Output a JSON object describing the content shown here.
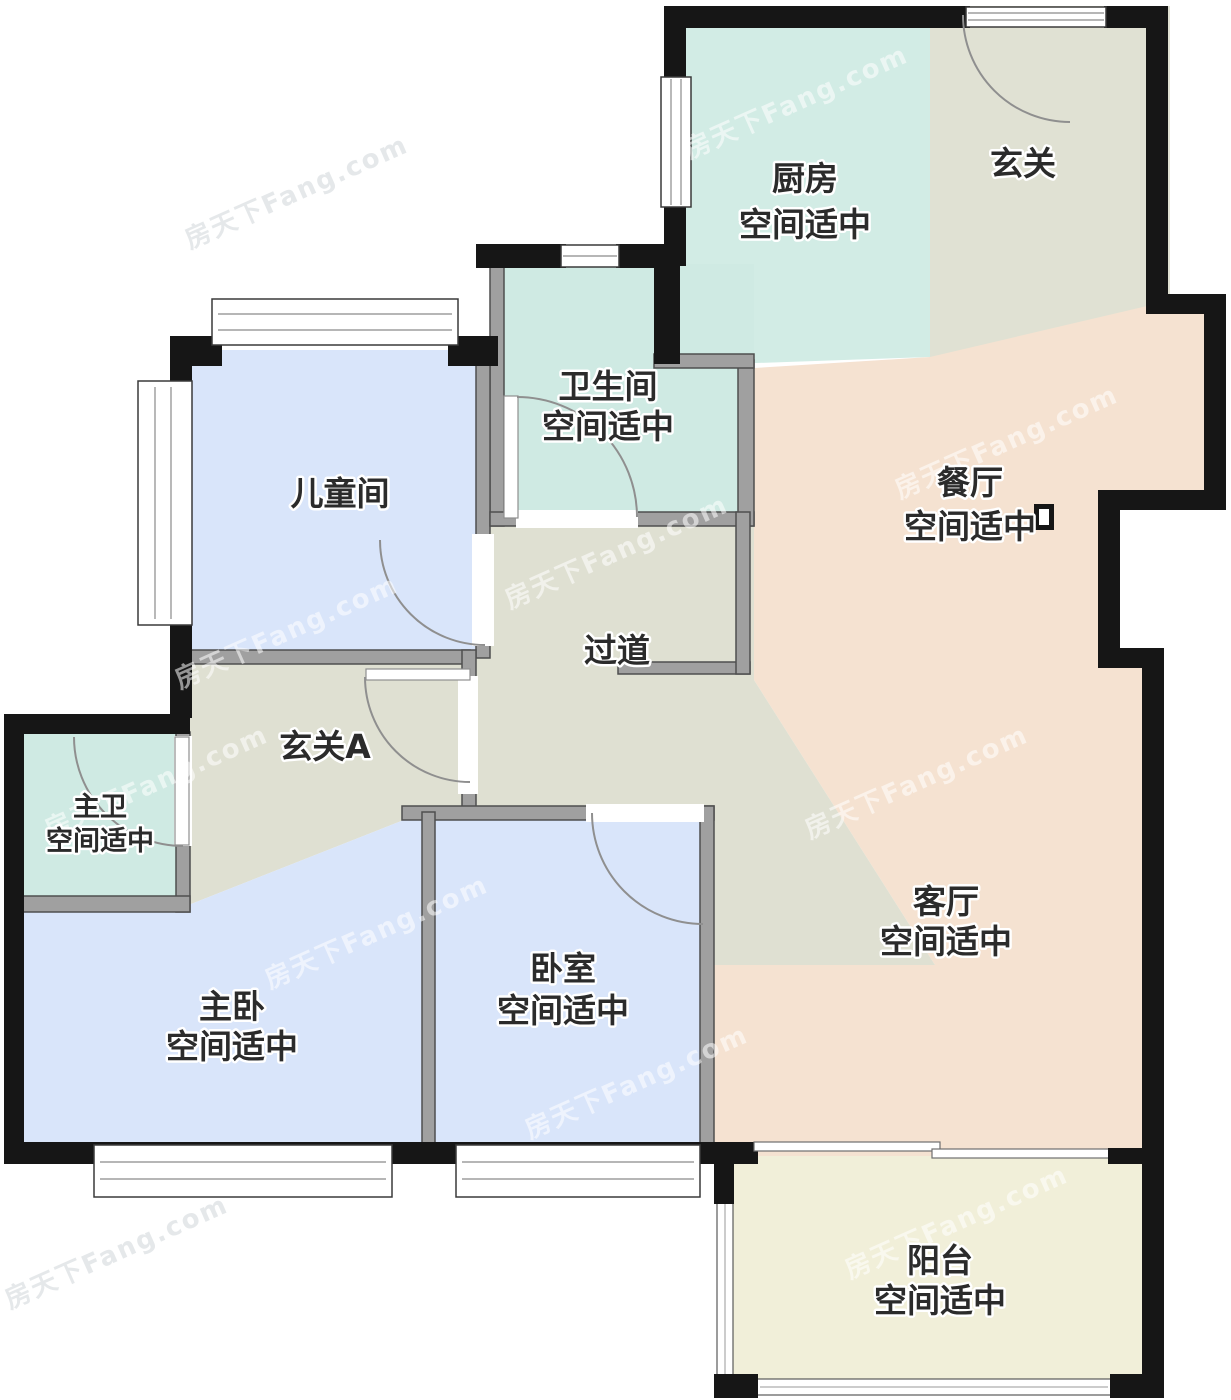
{
  "watermark": "房天下Fang.com",
  "colors": {
    "kitchen": "#d2ece5",
    "bath": "#cfeae3",
    "entry": "#e0e1d3",
    "hall": "#dfe0d2",
    "peach": "#f5e2d1",
    "bedroom": "#d9e5fa",
    "balcony": "#f1efd9"
  },
  "rooms": {
    "kitchen": {
      "name": "厨房",
      "note": "空间适中"
    },
    "entry": {
      "name": "玄关"
    },
    "bathroom": {
      "name": "卫生间",
      "note": "空间适中"
    },
    "dining": {
      "name": "餐厅",
      "note": "空间适中"
    },
    "kids": {
      "name": "儿童间"
    },
    "hallway": {
      "name": "过道"
    },
    "entryA": {
      "name": "玄关A"
    },
    "master_bath": {
      "name": "主卫",
      "note": "空间适中"
    },
    "living": {
      "name": "客厅",
      "note": "空间适中"
    },
    "master_bed": {
      "name": "主卧",
      "note": "空间适中"
    },
    "bedroom": {
      "name": "卧室",
      "note": "空间适中"
    },
    "balcony": {
      "name": "阳台",
      "note": "空间适中"
    }
  }
}
